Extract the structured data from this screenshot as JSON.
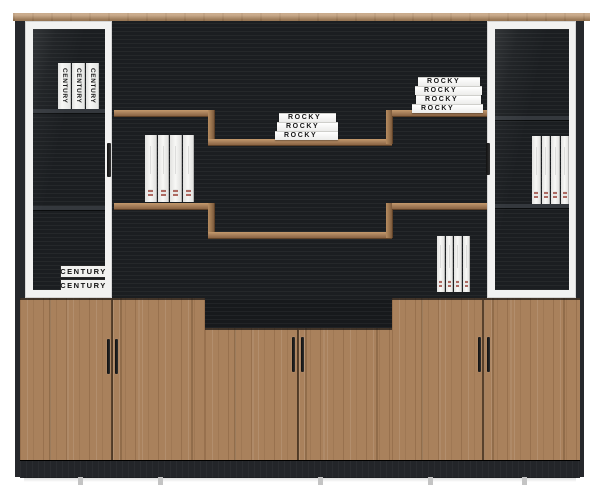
{
  "books": {
    "rocky_middle_stack": [
      "ROCKY",
      "ROCKY",
      "ROCKY"
    ],
    "rocky_right_stack": [
      "ROCKY",
      "ROCKY",
      "ROCKY",
      "ROCKY"
    ],
    "century_upright": [
      "CENTURY",
      "CENTURY",
      "CENTURY"
    ],
    "century_stacked": [
      "CENTURY",
      "CENTURY"
    ]
  },
  "colors": {
    "wood": "#a9815c",
    "wood_light": "#b99168",
    "wood_dark": "#7c5a3c",
    "panel_black": "#1b1e21",
    "frame_white": "#f2f2f1",
    "spine_white": "#f4f4f2",
    "handle_dark": "#1d1d1d",
    "plinth_black": "#232529",
    "background": "#ffffff"
  }
}
